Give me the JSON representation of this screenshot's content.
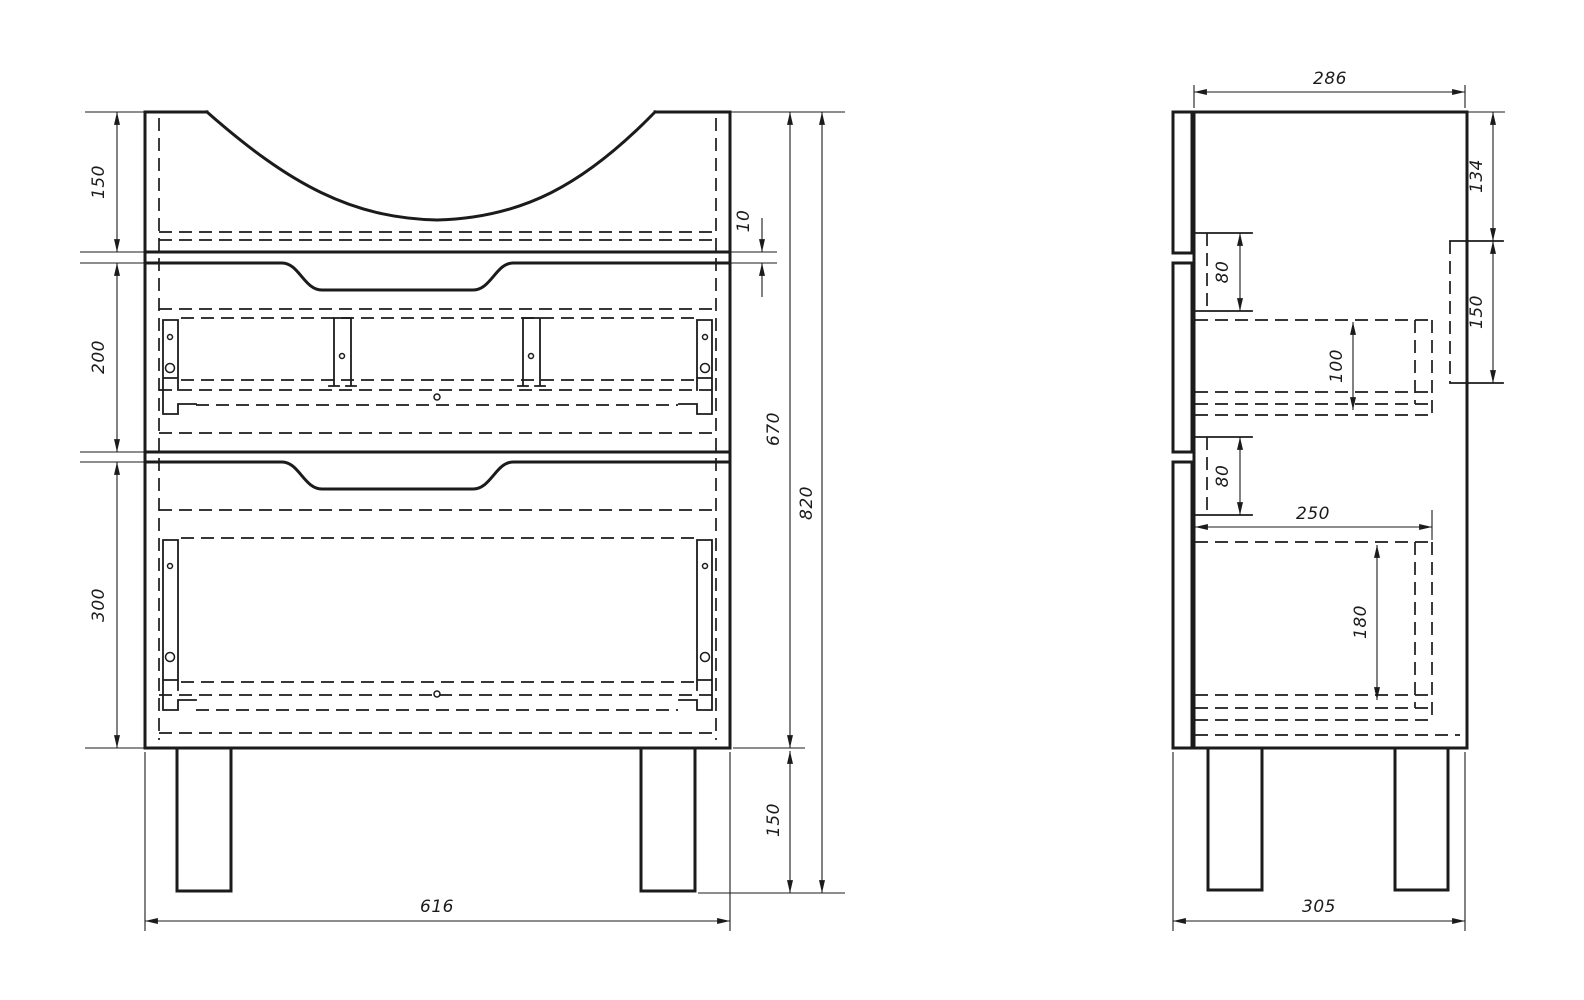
{
  "page": {
    "background_color": "#ffffff",
    "line_color": "#1b1b1b",
    "description": "Technical drawing of a vanity cabinet: front view and side view with dimensions"
  },
  "front_view": {
    "dims": {
      "top_section_height": "150",
      "drawer1_height": "200",
      "drawer2_height": "300",
      "front_gap": "10",
      "carcass_height": "670",
      "total_height": "820",
      "leg_height": "150",
      "width": "616"
    }
  },
  "side_view": {
    "dims": {
      "depth": "286",
      "top_to_rail": "134",
      "rail_height": "150",
      "slide1_height": "80",
      "drawer1_box_height": "100",
      "slide2_height": "80",
      "drawer_box_depth": "250",
      "drawer2_box_height": "180",
      "base_depth": "305"
    }
  }
}
